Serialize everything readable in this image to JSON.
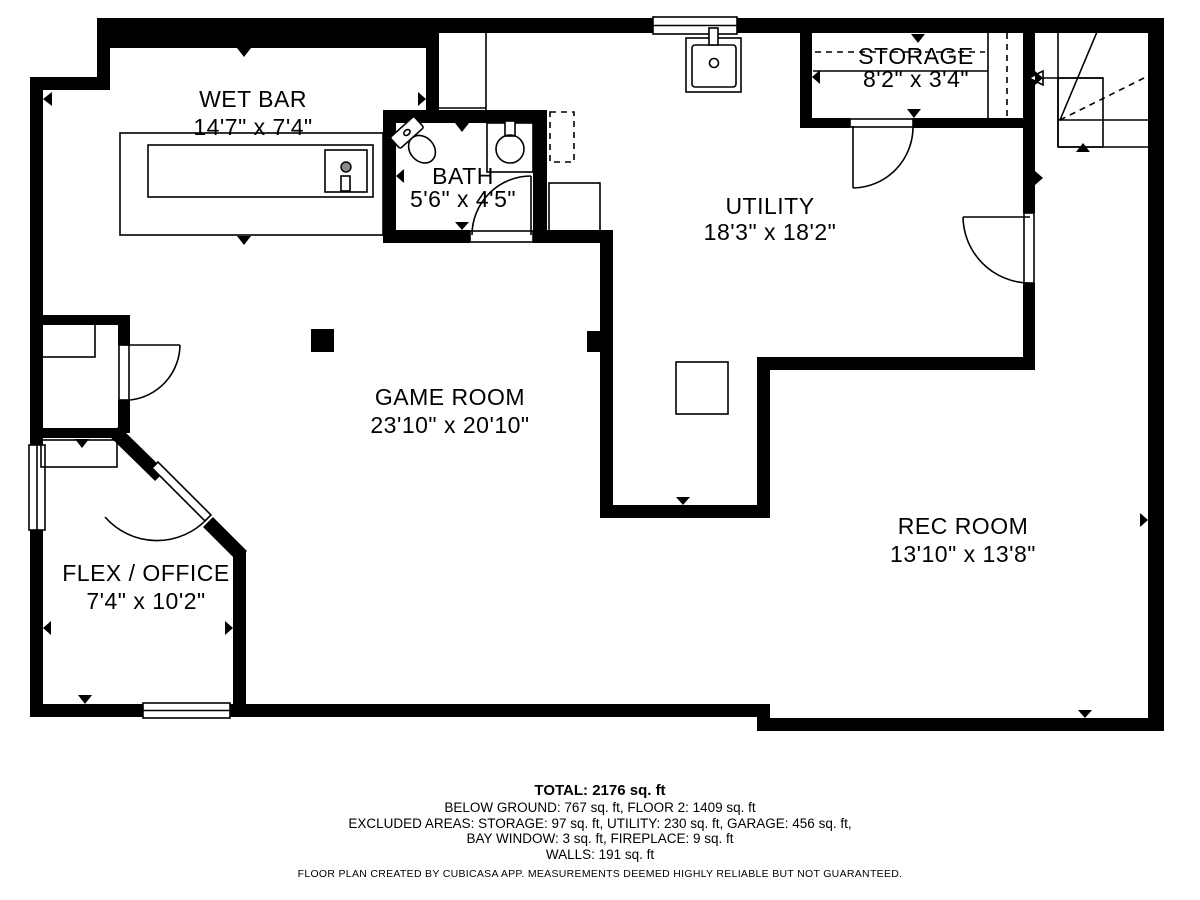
{
  "colors": {
    "wall": "#000000",
    "background": "#ffffff"
  },
  "rooms": {
    "wet_bar": {
      "name": "WET BAR",
      "dims": "14'7\" x 7'4\""
    },
    "bath": {
      "name": "BATH",
      "dims": "5'6\" x 4'5\""
    },
    "storage": {
      "name": "STORAGE",
      "dims": "8'2\" x 3'4\""
    },
    "utility": {
      "name": "UTILITY",
      "dims": "18'3\" x 18'2\""
    },
    "game_room": {
      "name": "GAME ROOM",
      "dims": "23'10\" x 20'10\""
    },
    "rec_room": {
      "name": "REC ROOM",
      "dims": "13'10\" x 13'8\""
    },
    "flex_office": {
      "name": "FLEX / OFFICE",
      "dims": "7'4\" x 10'2\""
    }
  },
  "footer": {
    "total": "TOTAL: 2176 sq. ft",
    "line1": "BELOW GROUND: 767 sq. ft, FLOOR 2: 1409 sq. ft",
    "line2": "EXCLUDED AREAS: STORAGE: 97 sq. ft, UTILITY: 230 sq. ft, GARAGE: 456 sq. ft,",
    "line3": "BAY WINDOW: 3 sq. ft, FIREPLACE: 9 sq. ft",
    "line4": "WALLS: 191 sq. ft",
    "disclaimer": "FLOOR PLAN CREATED BY CUBICASA APP. MEASUREMENTS DEEMED HIGHLY RELIABLE BUT NOT GUARANTEED."
  }
}
